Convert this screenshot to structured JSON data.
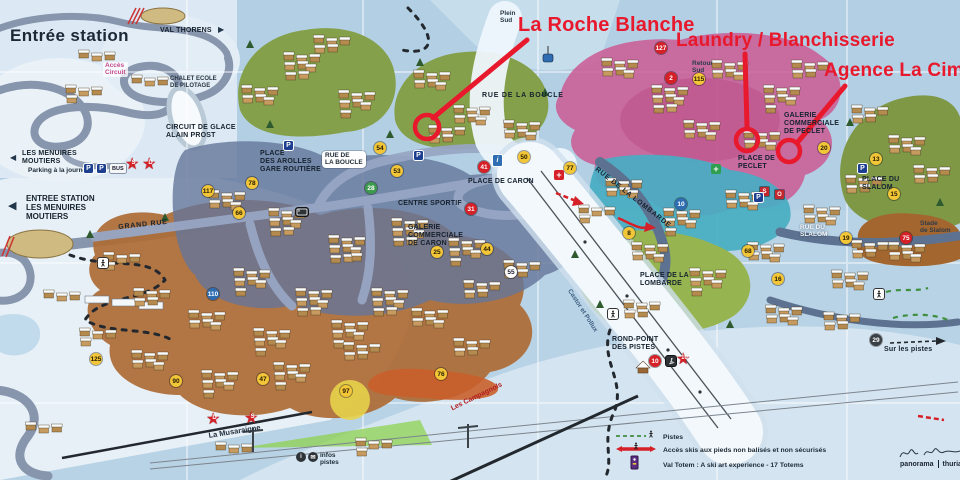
{
  "annotations": {
    "color": "#e8192c",
    "items": [
      {
        "id": "la-roche-blanche",
        "label": "La Roche Blanche",
        "text": {
          "x": 518,
          "y": 14,
          "size": 20
        },
        "line": {
          "x1": 527,
          "y1": 40,
          "x2": 433,
          "y2": 118
        },
        "circle": {
          "x": 427,
          "y": 127,
          "r": 12
        }
      },
      {
        "id": "laundry-blanchisserie",
        "label": "Laundry / Blanchisserie",
        "text": {
          "x": 676,
          "y": 30,
          "size": 19
        },
        "line": {
          "x1": 745,
          "y1": 54,
          "x2": 747,
          "y2": 127
        },
        "circle": {
          "x": 747,
          "y": 140,
          "r": 11
        }
      },
      {
        "id": "agence-la-cime",
        "label": "Agence La Cime",
        "text": {
          "x": 824,
          "y": 60,
          "size": 19
        },
        "line": {
          "x1": 845,
          "y1": 86,
          "x2": 797,
          "y2": 143
        },
        "circle": {
          "x": 789,
          "y": 151,
          "r": 11
        }
      }
    ]
  },
  "inset": {
    "labels": [
      {
        "id": "inset-title",
        "text": "Entrée station",
        "x": 10,
        "y": 26,
        "cls": "inset-title"
      },
      {
        "id": "inset-val-thorens",
        "text": "VAL THORENS",
        "x": 160,
        "y": 27,
        "cls": "lbl-place"
      },
      {
        "id": "inset-val-thorens-arrow",
        "text": "▶",
        "x": 218,
        "y": 25,
        "cls": "arrow-dark"
      },
      {
        "id": "inset-acces-circuit",
        "text": "Accès\nCircuit",
        "x": 103,
        "y": 62,
        "cls": "lbl-pink"
      },
      {
        "id": "inset-chalet-ecole",
        "text": "CHALET ECOLE\nDE PILOTAGE",
        "x": 170,
        "y": 76,
        "cls": "lbl-tiny"
      },
      {
        "id": "inset-circuit-glace",
        "text": "CIRCUIT DE GLACE\nALAIN PROST",
        "x": 166,
        "y": 124,
        "cls": "lbl-place"
      },
      {
        "id": "inset-menuires-arrow",
        "text": "◀",
        "x": 10,
        "y": 153,
        "cls": "arrow-dark"
      },
      {
        "id": "inset-les-menuires",
        "text": "LES MENUIRES\nMOUTIERS",
        "x": 22,
        "y": 150,
        "cls": "lbl-place"
      },
      {
        "id": "inset-parking",
        "text": "Parking à la journée",
        "x": 28,
        "y": 167,
        "cls": "lbl-tiny-b"
      },
      {
        "id": "entree-station-arrow",
        "text": "◀",
        "x": 8,
        "y": 200,
        "cls": "arrow-dark-lg"
      },
      {
        "id": "entree-station",
        "text": "ENTREE STATION\nLES MENUIRES\nMOUTIERS",
        "x": 26,
        "y": 194,
        "cls": "lbl-place-lg"
      }
    ]
  },
  "map": {
    "labels": [
      {
        "id": "grand-rue",
        "text": "GRAND RUE",
        "x": 118,
        "y": 224,
        "cls": "lbl-street",
        "rot": -6
      },
      {
        "id": "place-des-arolles",
        "text": "PLACE\nDES AROLLES\nGARE ROUTIÈRE",
        "x": 260,
        "y": 150,
        "cls": "lbl-place"
      },
      {
        "id": "rue-de-la-boucle-bubble",
        "text": "RUE DE\nLA BOUCLE",
        "x": 322,
        "y": 151,
        "cls": "lbl-bubble"
      },
      {
        "id": "rue-de-la-boucle",
        "text": "RUE DE LA BOUCLE",
        "x": 482,
        "y": 92,
        "cls": "lbl-street"
      },
      {
        "id": "plein-sud",
        "text": "Plein\nSud",
        "x": 500,
        "y": 10,
        "cls": "lbl-small"
      },
      {
        "id": "retour-sud",
        "text": "Retour\nSud",
        "x": 692,
        "y": 60,
        "cls": "lbl-small"
      },
      {
        "id": "place-de-caron",
        "text": "PLACE DE CARON",
        "x": 468,
        "y": 178,
        "cls": "lbl-place"
      },
      {
        "id": "centre-sportif",
        "text": "CENTRE SPORTIF",
        "x": 398,
        "y": 200,
        "cls": "lbl-place"
      },
      {
        "id": "galerie-caron",
        "text": "GALERIE\nCOMMERCIALE\nDE CARON",
        "x": 408,
        "y": 224,
        "cls": "lbl-place"
      },
      {
        "id": "place-de-peclet",
        "text": "PLACE DE\nPECLET",
        "x": 738,
        "y": 155,
        "cls": "lbl-place"
      },
      {
        "id": "galerie-peclet",
        "text": "GALERIE\nCOMMERCIALE\nDE PECLET",
        "x": 784,
        "y": 112,
        "cls": "lbl-place"
      },
      {
        "id": "rue-de-la-lombarde",
        "text": "RUE DE LA LOMBARDE",
        "x": 598,
        "y": 166,
        "cls": "lbl-street",
        "rot": 38
      },
      {
        "id": "place-de-la-lombarde",
        "text": "PLACE DE LA\nLOMBARDE",
        "x": 640,
        "y": 272,
        "cls": "lbl-place"
      },
      {
        "id": "rue-du-slalom",
        "text": "RUE DU\nSLALOM",
        "x": 800,
        "y": 224,
        "cls": "lbl-white"
      },
      {
        "id": "place-du-slalom",
        "text": "PLACE DU\nSLALOM",
        "x": 862,
        "y": 176,
        "cls": "lbl-place"
      },
      {
        "id": "stade-de-slalom",
        "text": "Stade\nde Slalom",
        "x": 920,
        "y": 220,
        "cls": "lbl-small"
      },
      {
        "id": "rond-point-des-pistes",
        "text": "ROND-POINT\nDES PISTES",
        "x": 612,
        "y": 336,
        "cls": "lbl-place"
      },
      {
        "id": "la-musaraigne",
        "text": "La Musaraigne",
        "x": 208,
        "y": 432,
        "cls": "lbl-slope-dk",
        "rot": -9
      },
      {
        "id": "les-campagnols",
        "text": "Les Campagnols",
        "x": 450,
        "y": 406,
        "cls": "lbl-slope-rd",
        "rot": -26
      },
      {
        "id": "castor-et-pollux",
        "text": "Castor et Pollux",
        "x": 572,
        "y": 288,
        "cls": "lbl-lift",
        "rot": 57
      },
      {
        "id": "infos-pistes",
        "text": "infos\npistes",
        "x": 320,
        "y": 452,
        "cls": "lbl-tiny-b"
      },
      {
        "id": "sur-les-pistes",
        "text": "Sur les pistes",
        "x": 884,
        "y": 346,
        "cls": "lbl-place"
      }
    ],
    "markers": [
      {
        "n": "54",
        "x": 380,
        "y": 148,
        "t": "y"
      },
      {
        "n": "53",
        "x": 397,
        "y": 171,
        "t": "y"
      },
      {
        "n": "50",
        "x": 524,
        "y": 157,
        "t": "y"
      },
      {
        "n": "77",
        "x": 570,
        "y": 168,
        "t": "y"
      },
      {
        "n": "41",
        "x": 484,
        "y": 167,
        "t": "r"
      },
      {
        "n": "31",
        "x": 471,
        "y": 209,
        "t": "r"
      },
      {
        "n": "25",
        "x": 437,
        "y": 252,
        "t": "y"
      },
      {
        "n": "44",
        "x": 487,
        "y": 249,
        "t": "y"
      },
      {
        "n": "28",
        "x": 371,
        "y": 188,
        "t": "g"
      },
      {
        "n": "117",
        "x": 208,
        "y": 191,
        "t": "y"
      },
      {
        "n": "110",
        "x": 213,
        "y": 294,
        "t": "b"
      },
      {
        "n": "125",
        "x": 96,
        "y": 359,
        "t": "y"
      },
      {
        "n": "90",
        "x": 176,
        "y": 381,
        "t": "y"
      },
      {
        "n": "47",
        "x": 263,
        "y": 379,
        "t": "y"
      },
      {
        "n": "78",
        "x": 252,
        "y": 183,
        "t": "y"
      },
      {
        "n": "66",
        "x": 239,
        "y": 213,
        "t": "y"
      },
      {
        "n": "20",
        "x": 824,
        "y": 148,
        "t": "y"
      },
      {
        "n": "13",
        "x": 876,
        "y": 159,
        "t": "y"
      },
      {
        "n": "15",
        "x": 894,
        "y": 194,
        "t": "y"
      },
      {
        "n": "19",
        "x": 846,
        "y": 238,
        "t": "y"
      },
      {
        "n": "10",
        "x": 681,
        "y": 204,
        "t": "b"
      },
      {
        "n": "8",
        "x": 629,
        "y": 233,
        "t": "y"
      },
      {
        "n": "68",
        "x": 748,
        "y": 251,
        "t": "y"
      },
      {
        "n": "16",
        "x": 778,
        "y": 279,
        "t": "y"
      },
      {
        "n": "75",
        "x": 906,
        "y": 238,
        "t": "r"
      },
      {
        "n": "97",
        "x": 346,
        "y": 391,
        "t": "y"
      },
      {
        "n": "76",
        "x": 441,
        "y": 374,
        "t": "y"
      },
      {
        "n": "2",
        "x": 671,
        "y": 78,
        "t": "r"
      },
      {
        "n": "115",
        "x": 699,
        "y": 79,
        "t": "y"
      },
      {
        "n": "127",
        "x": 661,
        "y": 48,
        "t": "r"
      },
      {
        "n": "29",
        "x": 876,
        "y": 340,
        "t": "dk"
      },
      {
        "n": "55",
        "x": 511,
        "y": 272,
        "t": "w"
      },
      {
        "n": "10",
        "x": 655,
        "y": 361,
        "t": "r"
      },
      {
        "n": "10",
        "x": 684,
        "y": 361,
        "t": "rs"
      },
      {
        "n": "D",
        "x": 214,
        "y": 421,
        "t": "rs"
      },
      {
        "n": "S",
        "x": 252,
        "y": 420,
        "t": "rs"
      },
      {
        "n": "S",
        "x": 133,
        "y": 166,
        "t": "rs"
      },
      {
        "n": "D",
        "x": 150,
        "y": 166,
        "t": "rs"
      },
      {
        "n": "S",
        "x": 764,
        "y": 191,
        "t": "sq"
      },
      {
        "n": "O",
        "x": 779,
        "y": 194,
        "t": "sq"
      }
    ],
    "chips": [
      {
        "k": "p",
        "t": "P",
        "x": 284,
        "y": 141
      },
      {
        "k": "p",
        "t": "P",
        "x": 414,
        "y": 151
      },
      {
        "k": "p",
        "t": "P",
        "x": 754,
        "y": 193
      },
      {
        "k": "p",
        "t": "P",
        "x": 858,
        "y": 164
      },
      {
        "k": "p",
        "t": "P",
        "x": 84,
        "y": 164
      },
      {
        "k": "p",
        "t": "P",
        "x": 97,
        "y": 164
      },
      {
        "k": "bus",
        "t": "BUS",
        "x": 110,
        "y": 164
      },
      {
        "k": "flag-i",
        "t": "i",
        "x": 493,
        "y": 155
      },
      {
        "k": "cross-red",
        "t": "+",
        "x": 554,
        "y": 170
      },
      {
        "k": "cross-green",
        "t": "+",
        "x": 711,
        "y": 164
      },
      {
        "k": "i-dark",
        "t": "i",
        "x": 296,
        "y": 452
      },
      {
        "k": "mail-dark",
        "t": "✉",
        "x": 308,
        "y": 452
      },
      {
        "k": "walk",
        "t": "",
        "x": 98,
        "y": 258
      },
      {
        "k": "walk",
        "t": "",
        "x": 608,
        "y": 309
      },
      {
        "k": "walk",
        "t": "",
        "x": 874,
        "y": 289
      },
      {
        "k": "skier-dark",
        "t": "",
        "x": 666,
        "y": 356
      },
      {
        "k": "bus-dark",
        "t": "",
        "x": 296,
        "y": 208
      }
    ]
  },
  "legend": {
    "items": [
      {
        "id": "pistes",
        "icon": "piste",
        "label": "Pistes"
      },
      {
        "id": "acces-skis",
        "icon": "acces",
        "label": "Accès skis aux pieds non balisés et non sécurisés"
      },
      {
        "id": "val-totem",
        "icon": "totem",
        "label": "Val Totem : A ski art experience - 17 Totems"
      }
    ]
  },
  "credit": {
    "brand_left": "panorama",
    "brand_right": "thuria"
  }
}
